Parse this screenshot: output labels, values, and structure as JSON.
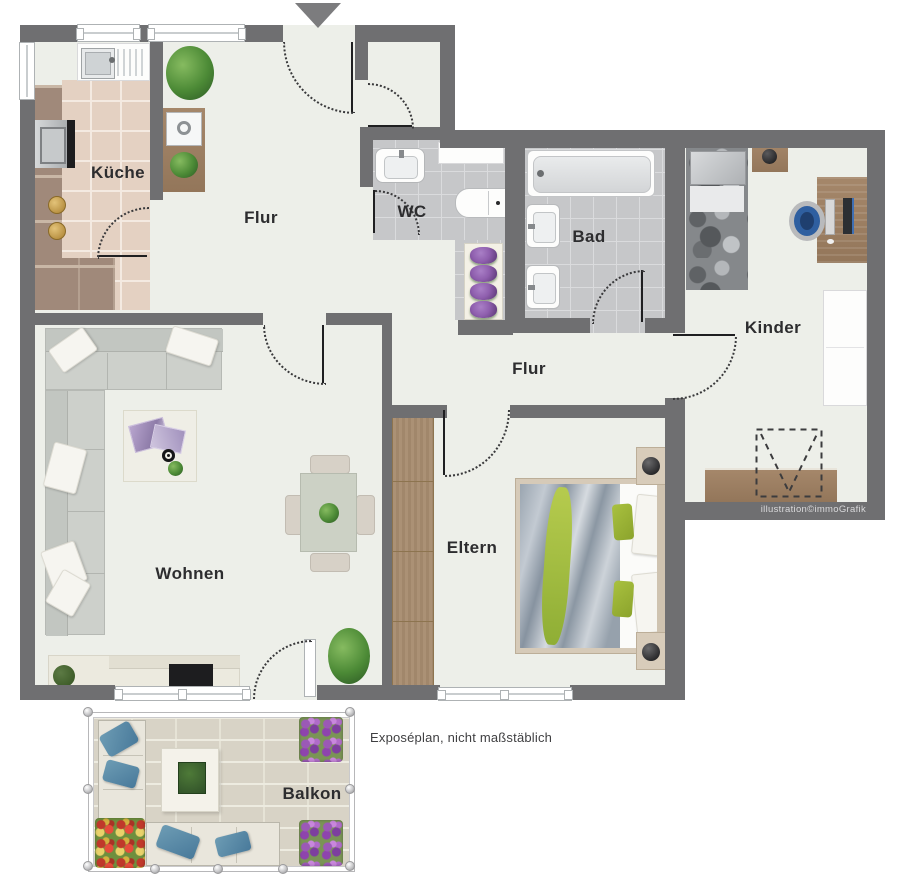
{
  "rooms": [
    {
      "id": "kueche",
      "label": "Küche"
    },
    {
      "id": "flur-entrance",
      "label": "Flur"
    },
    {
      "id": "wc",
      "label": "WC"
    },
    {
      "id": "bad",
      "label": "Bad"
    },
    {
      "id": "kinder",
      "label": "Kinder"
    },
    {
      "id": "flur-middle",
      "label": "Flur"
    },
    {
      "id": "wohnen",
      "label": "Wohnen"
    },
    {
      "id": "eltern",
      "label": "Eltern"
    },
    {
      "id": "balkon",
      "label": "Balkon"
    }
  ],
  "notes": {
    "disclaimer": "Exposéplan, nicht maßstäblich",
    "credit": "illustration©immoGrafik"
  },
  "colors": {
    "wall": "#6f6f71",
    "floor": "#edefe9",
    "bath_tile": "#c6c7c9",
    "kitchen_tile": "#e4d1c2",
    "wood": "#9b7e5e",
    "accent_green": "#a7c03c",
    "pillow_blue": "#5d90a8",
    "flower_purple": "#8e44ad"
  }
}
